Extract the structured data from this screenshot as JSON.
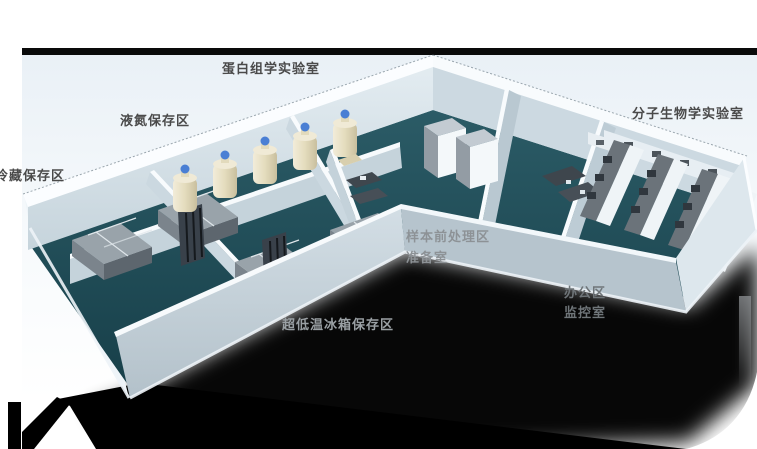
{
  "scene": {
    "description": "isometric 3D floor plan of a biobank laboratory",
    "labels": {
      "proteomics": {
        "text": "蛋白组学实验室"
      },
      "liquid_nitrogen": {
        "text": "液氮保存区"
      },
      "cold_storage": {
        "text": "冷藏保存区"
      },
      "molecular_biology": {
        "text": "分子生物学实验室"
      },
      "sample_pretreatment": {
        "text": "样本前处理区"
      },
      "preparation": {
        "text": "准备室"
      },
      "office": {
        "text": "办公区"
      },
      "monitoring": {
        "text": "监控室"
      },
      "ult_freezer": {
        "text": "超低温冰箱保存区"
      }
    },
    "colors": {
      "page_bg": "#ffffff",
      "panel_tint": "#e9f0f6",
      "top_bar": "#0a0a0a",
      "floor_teal": "#1d4a54",
      "wall_light": "#e8f0f4",
      "wall_shaded": "#c2d0d8",
      "wall_top_white": "#fafdfe",
      "equipment_gray": "#99a3aa",
      "equipment_dark": "#39414a",
      "tank_body": "#e6dfc6",
      "tank_cap": "#4a7fd4",
      "shadow": "#000000",
      "label_dark": "#4a4a4a",
      "label_gray": "#8d9296"
    }
  }
}
